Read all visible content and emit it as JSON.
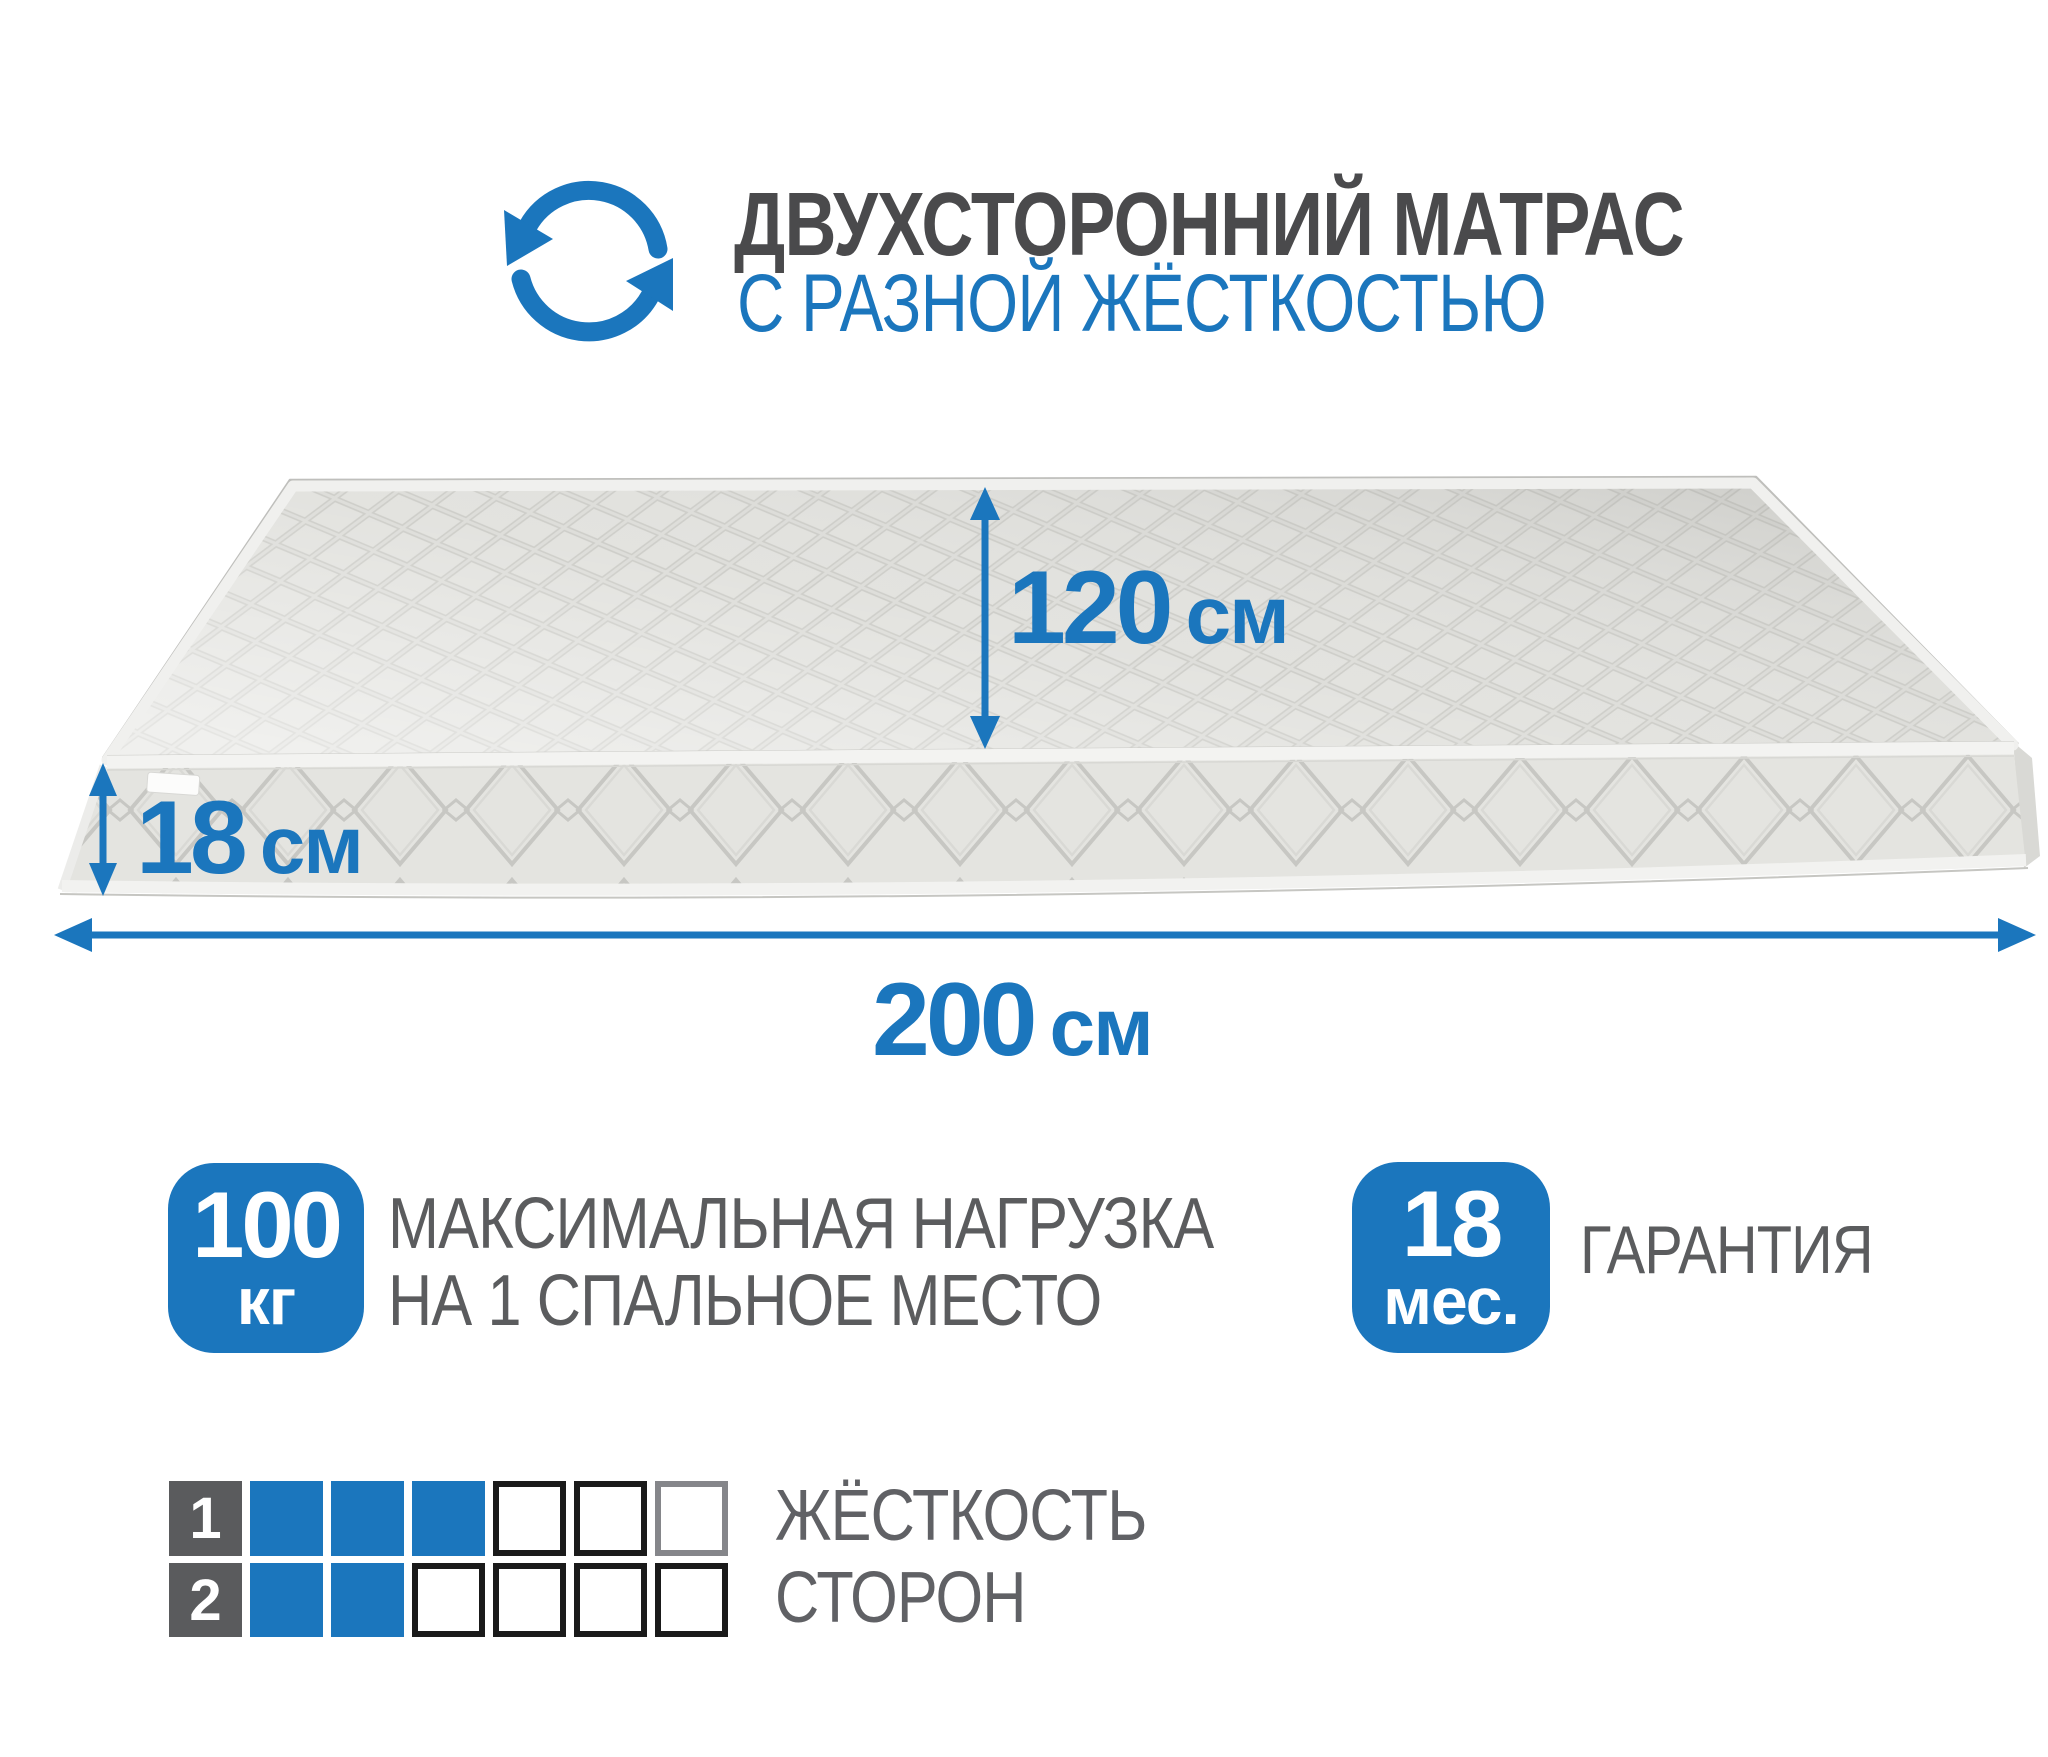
{
  "header": {
    "title": "ДВУХСТОРОННИЙ МАТРАС",
    "subtitle": "С РАЗНОЙ ЖЁСТКОСТЬЮ",
    "icon": "rotate-arrows-icon"
  },
  "dimensions": {
    "depth": {
      "value": "120",
      "unit": "см"
    },
    "height": {
      "value": "18",
      "unit": "см"
    },
    "length": {
      "value": "200",
      "unit": "см"
    }
  },
  "features": {
    "max_load": {
      "badge_value": "100",
      "badge_unit": "кг",
      "label_line1": "МАКСИМАЛЬНАЯ НАГРУЗКА",
      "label_line2": "НА 1 СПАЛЬНОЕ МЕСТО"
    },
    "warranty": {
      "badge_value": "18",
      "badge_unit": "мес.",
      "label": "ГАРАНТИЯ"
    }
  },
  "firmness": {
    "label_line1": "ЖЁСТКОСТЬ",
    "label_line2": "СТОРОН",
    "scale_max": 6,
    "sides": [
      {
        "side": "1",
        "level": 3
      },
      {
        "side": "2",
        "level": 2
      }
    ],
    "muted_cells": [
      {
        "row": 0,
        "cell": 5
      }
    ]
  },
  "colors": {
    "accent": "#1b76bd",
    "title_gray": "#4a4a4c",
    "text_gray": "#5b5c5e",
    "label_square": "#5a5b5d",
    "cell_border": "#1a1a1a",
    "muted_border": "#85868a"
  }
}
